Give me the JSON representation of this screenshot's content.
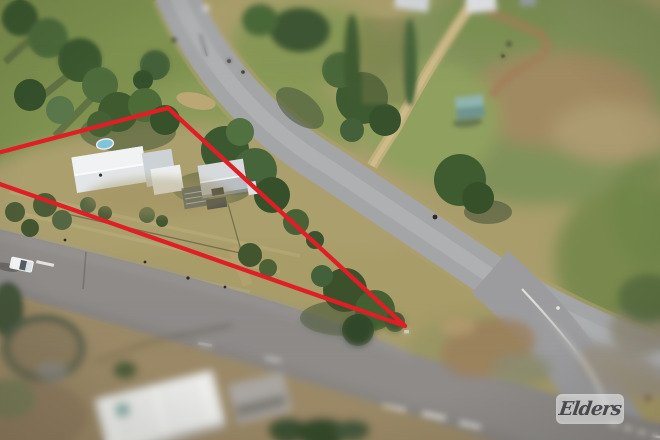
{
  "image": {
    "kind": "aerial-drone-photo",
    "description": "Aerial photo of a triangular rural corner block outlined in red at a road junction, with a house, sheds and trees inside the boundary",
    "width_px": 660,
    "height_px": 440
  },
  "watermark": {
    "brand": "Elders"
  },
  "boundary": {
    "color": "#e01e25",
    "stroke_width": 4.3,
    "vertices_px": [
      [
        -52,
        166
      ],
      [
        168,
        108
      ],
      [
        405,
        326
      ]
    ]
  },
  "palette": {
    "grass_dry": "#a89d6b",
    "grass_green": "#7e9150",
    "paddock_green": "#81915a",
    "road_main": "#8e8b89",
    "road_side": "#a4a5a7",
    "dirt_track": "#c4b080",
    "dirt_brown": "#9a8866",
    "tree_dark": "#3c5830",
    "tree_mid": "#4c6b37",
    "roof_white": "#e3e6e8",
    "roof_gray": "#b9bec2",
    "pool_blue": "#7fc4d9",
    "car_white": "#f4f6f7",
    "marking_white": "#eceae2",
    "teal_shed": "#8fb3ad"
  },
  "objects": {
    "boundary_shape": "triangle with arrow-like tip pointing at road junction",
    "main_road": "sealed road running lower-left to bottom-right corner with white centre dashes",
    "side_road": "sealed road curving from top-left down to the junction",
    "house": "light metal-roof house inside boundary",
    "shed": "white gable shed beside house",
    "pool": "small above-ground pool",
    "vehicle": "white ute driving on main road",
    "teal_shed": "small teal shed in rear paddock",
    "dirt_track": "dirt driveway through neighbouring paddock",
    "foreground_house": "blurred white roof house in bottom foreground"
  }
}
